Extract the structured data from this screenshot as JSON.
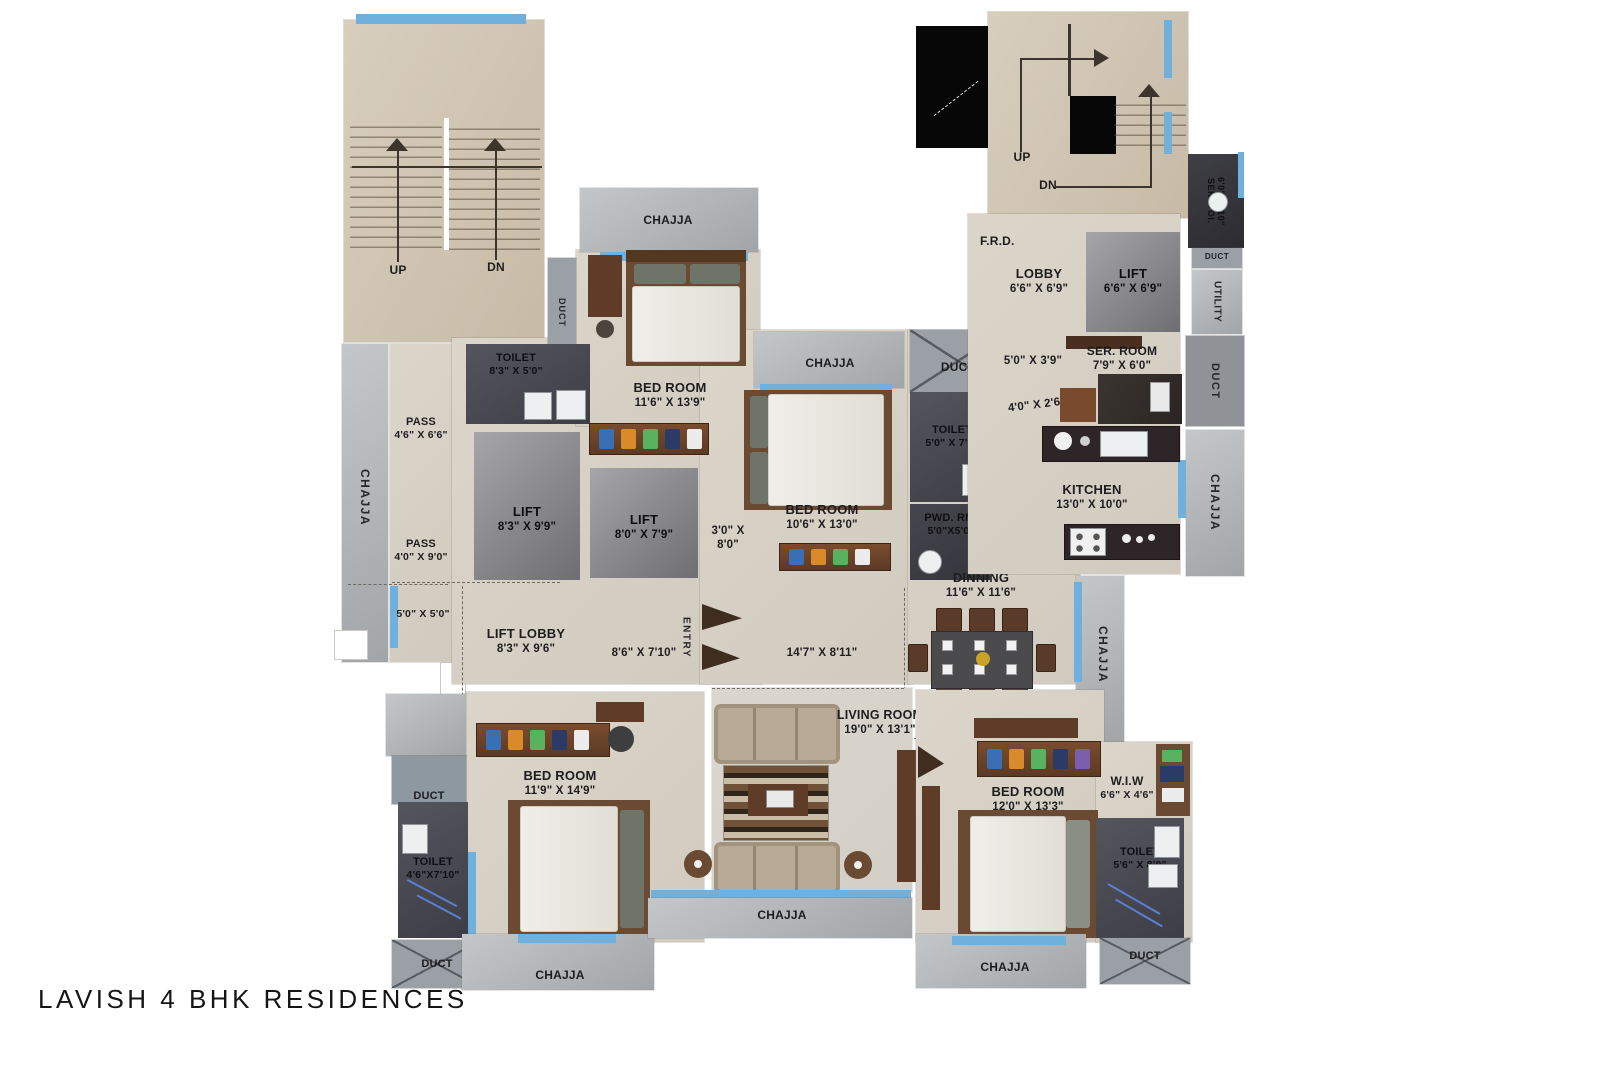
{
  "title": "LAVISH 4 BHK RESIDENCES",
  "common": {
    "chajja": "CHAJJA",
    "duct": "DUCT",
    "up": "UP",
    "dn": "DN",
    "entry": "ENTRY",
    "frd": "F.R.D.",
    "utility": "UTILITY"
  },
  "rooms": {
    "toilet_top": {
      "name": "TOILET",
      "dims": "8'3\" X 5'0\""
    },
    "bedroom_top": {
      "name": "BED ROOM",
      "dims": "11'6\" X 13'9\""
    },
    "pass_upper": {
      "name": "PASS",
      "dims": "4'6\" X 6'6\""
    },
    "pass_lower": {
      "name": "PASS",
      "dims": "4'0\" X 9'0\""
    },
    "lift_left": {
      "name": "LIFT",
      "dims": "8'3\" X 9'9\""
    },
    "lift_mid": {
      "name": "LIFT",
      "dims": "8'0\" X 7'9\""
    },
    "bedroom_mid": {
      "name": "BED ROOM",
      "dims": "10'6\" X 13'0\""
    },
    "toilet_mid": {
      "name": "TOILET",
      "dims": "5'0\" X 7'6\""
    },
    "pwd_rm": {
      "name": "PWD. RM.",
      "dims": "5'0\"X5'0\""
    },
    "dinning": {
      "name": "DINNING",
      "dims": "11'6\" X 11'6\""
    },
    "lobby": {
      "name": "LOBBY",
      "dims": "6'6\" X 6'9\""
    },
    "lift_right": {
      "name": "LIFT",
      "dims": "6'6\" X 6'9\""
    },
    "ser_toi": {
      "name": "SER. TOI.",
      "dims": "6'0\"X2'10\""
    },
    "ser_room": {
      "name": "SER. ROOM",
      "dims": "7'9\" X 6'0\""
    },
    "kitchen": {
      "name": "KITCHEN",
      "dims": "13'0\" X 10'0\""
    },
    "lift_lobby": {
      "name": "LIFT LOBBY",
      "dims": "8'3\" X 9'6\""
    },
    "living": {
      "name": "LIVING ROOM",
      "dims": "19'0\" X 13'1\""
    },
    "bedroom_bl": {
      "name": "BED ROOM",
      "dims": "11'9\" X 14'9\""
    },
    "toilet_bl": {
      "name": "TOILET",
      "dims": "4'6\"X7'10\""
    },
    "bedroom_br": {
      "name": "BED ROOM",
      "dims": "12'0\" X 13'3\""
    },
    "wiw": {
      "name": "W.I.W",
      "dims": "6'6\" X 4'6\""
    },
    "toilet_br": {
      "name": "TOILET",
      "dims": "5'6\" X 8'0\""
    }
  },
  "dims": {
    "d5x5": "5'0\" X 5'0\"",
    "d3x8": "3'0\" X 8'0\"",
    "d5x39": "5'0\" X 3'9\"",
    "d4x26": "4'0\" X 2'6\"",
    "d86x710": "8'6\" X 7'10\"",
    "d147x811": "14'7\" X 8'11\""
  },
  "colors": {
    "window_blue": "#6fb0dc",
    "floor_beige": "#d7d1c5",
    "stair_tan": "#cfc5b3",
    "chajja_gray": "#b4b7b9",
    "lift_gray": "#85858a",
    "dark_room": "#42424a",
    "wood_brown": "#6b4a33",
    "text": "#1d1d1f"
  }
}
